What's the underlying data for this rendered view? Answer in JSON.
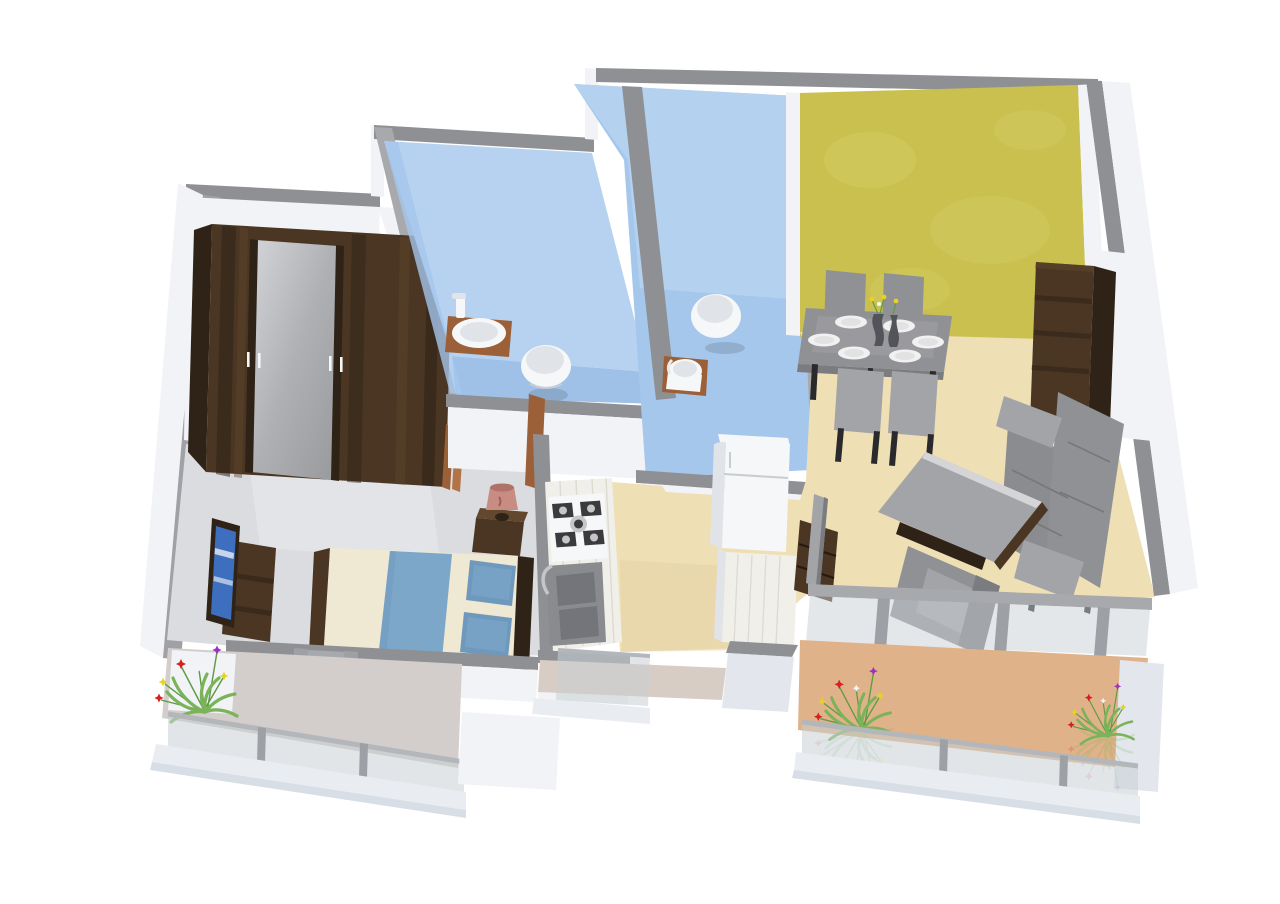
{
  "meta": {
    "kind": "3d-isometric-floor-plan-render",
    "canvas": {
      "width": 1280,
      "height": 904
    },
    "background": "#ffffff"
  },
  "palette": {
    "bg": "#ffffff",
    "capGray": "#8f9094",
    "capGrayDark": "#7e7f83",
    "capGrayLight": "#a8a9ad",
    "wallWhite": "#f2f3f6",
    "wallWhiteShade": "#e3e7ed",
    "wallInnerGray": "#9fa1a6",
    "skirtWhite": "#e9edf2",
    "skirtShade": "#d8dee6",
    "bedroomFloor": "#dbdcdf",
    "bedroomFloorLight": "#e6e7e9",
    "bathWallLight": "#b6d2f0",
    "bathWall": "#a5c7ec",
    "bathFloor": "#9fc1e8",
    "bathFloorDark": "#8fb3dc",
    "yellowWall": "#c9c04f",
    "yellowWallLight": "#d6ce68",
    "beigeFloor": "#eedfb5",
    "beigeFloorDark": "#e4d2a2",
    "tanFloor": "#e0b289",
    "utilityFloor": "#d8cdc5",
    "leftBalconyFloor": "#d3cecb",
    "glass": "#c9d0d4",
    "glassRail": "#b3b7bb",
    "postGray": "#9da1a5",
    "woodDark": "#2f2318",
    "woodDarkMid": "#4a3622",
    "woodDarkLight": "#62482e",
    "doorWood": "#9c6038",
    "doorWoodLight": "#b27347",
    "furnGray": "#909195",
    "furnGrayLight": "#a3a4a8",
    "furnGrayDark": "#7b7c80",
    "sofaGray": "#8b8c90",
    "white": "#f6f7f9",
    "whiteShade": "#e0e3e8",
    "marble": "#f1efe9",
    "marbleShade": "#e2dfd6",
    "steel": "#c4c6c9",
    "sinkGray": "#8a8b8f",
    "sinkGrayDark": "#74757a",
    "bedCream": "#efe8d3",
    "bedBlue": "#7da7c9",
    "bedBlueDark": "#6e99bd",
    "tvBlue": "#3e6fbf",
    "lampPink": "#c98c82",
    "lampPinkDark": "#b0716a",
    "plateWhite": "#f1f1f1",
    "plateShade": "#e2e2e2",
    "leafGreen": "#7ab35a",
    "leafGreenDark": "#5f9a45",
    "flowerRed": "#d42222",
    "flowerYellow": "#e5d31f",
    "flowerPurple": "#9c30c0",
    "flowerWhite": "#f5f5f5",
    "vaseDark": "#53545a",
    "legDark": "#2a2a2c"
  },
  "rooms": [
    {
      "id": "bedroom",
      "wall_color": "#f2f3f6",
      "floor_color": "#dbdcdf",
      "objects": [
        "sliding-wardrobe-with-mirror",
        "double-bed-blue-runner",
        "pillows-x2",
        "bedside-table",
        "table-lamp",
        "tv-unit",
        "television"
      ]
    },
    {
      "id": "bathroom-1",
      "wall_color": "#b6d2f0",
      "floor_color": "#9fc1e8",
      "objects": [
        "washbasin-on-wood-shelf",
        "toilet"
      ]
    },
    {
      "id": "bathroom-2",
      "wall_color": "#b6d2f0",
      "floor_color": "#9fc1e8",
      "objects": [
        "wall-hung-toilet",
        "washbasin-on-wood-stand"
      ]
    },
    {
      "id": "kitchen",
      "floor_color": "#eedfb5",
      "objects": [
        "counter",
        "gas-hob-4-burner",
        "double-bowl-sink",
        "refrigerator",
        "service-counter"
      ]
    },
    {
      "id": "living-dining",
      "accent_wall_color": "#c9c04f",
      "floor_color": "#eedfb5",
      "objects": [
        "dining-table",
        "dining-chairs-x4",
        "dinner-plates-x6",
        "vases-x2",
        "flower-centerpiece",
        "sofa-3-seater",
        "armchair",
        "coffee-table",
        "tv-panel",
        "tv-cabinet",
        "tall-wood-cabinet"
      ]
    },
    {
      "id": "balcony-left",
      "floor_color": "#d3cecb",
      "objects": [
        "flower-plant",
        "glass-railing",
        "planter-box"
      ]
    },
    {
      "id": "balcony-utility",
      "floor_color": "#d8cdc5",
      "objects": [
        "glass-railing"
      ]
    },
    {
      "id": "balcony-right",
      "floor_color": "#e0b289",
      "objects": [
        "flower-plant",
        "flower-plant",
        "glass-railing",
        "sliding-glass-doors"
      ]
    }
  ],
  "counts": {
    "plates": 6,
    "dining_chairs": 4,
    "plants": 3,
    "bathrooms": 2,
    "balconies": 3
  }
}
